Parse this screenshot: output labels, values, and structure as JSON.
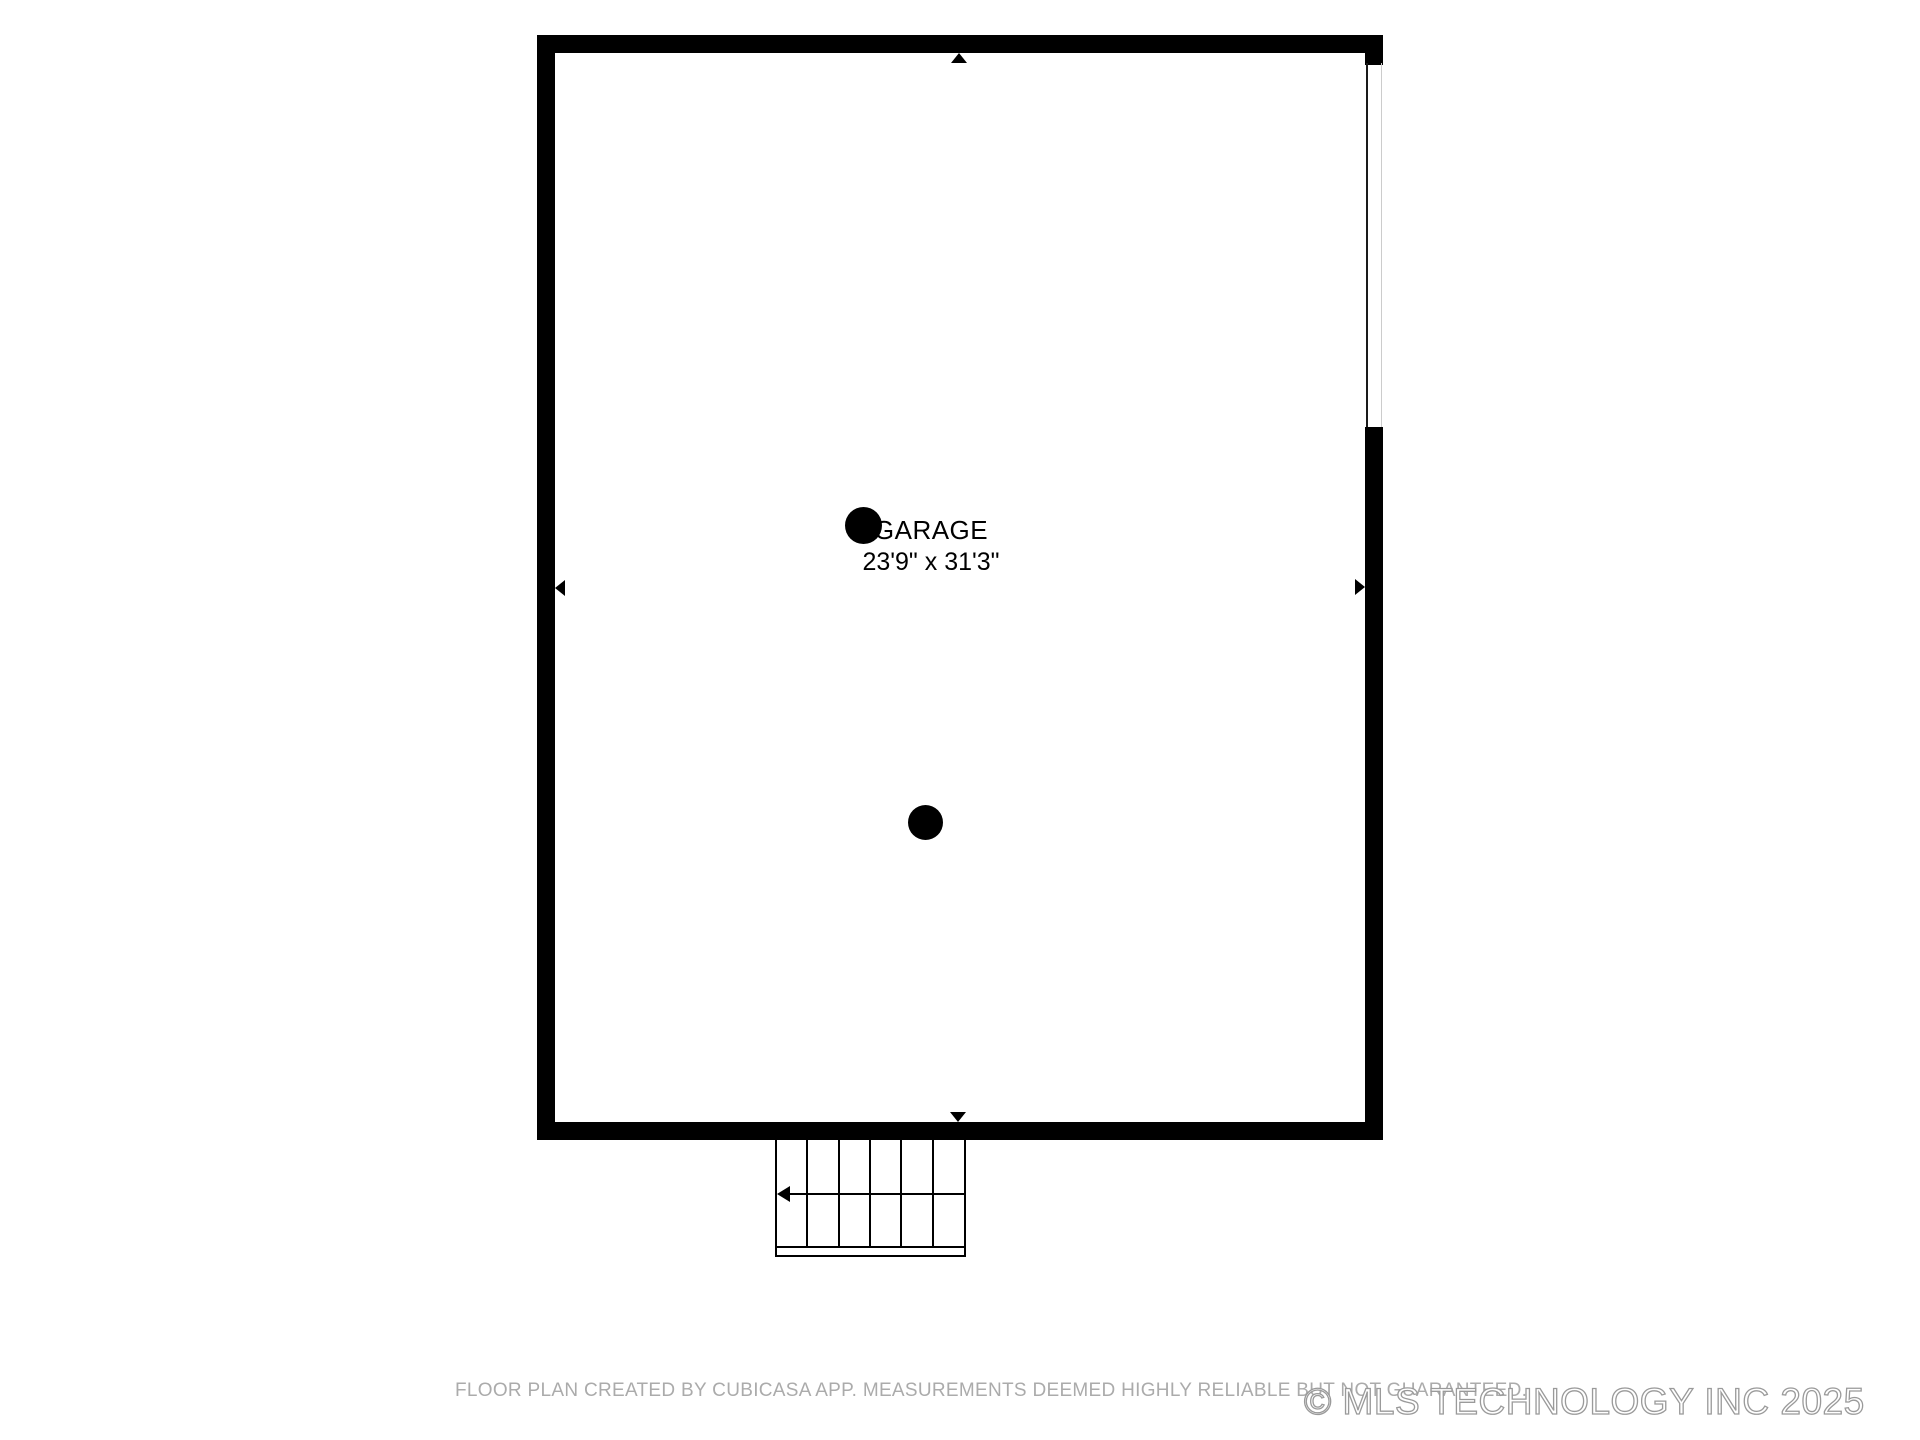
{
  "room": {
    "label": "GARAGE",
    "dimensions": "23'9\" x 31'3\""
  },
  "footer": {
    "disclaimer": "FLOOR PLAN CREATED BY CUBICASA APP. MEASUREMENTS DEEMED HIGHLY RELIABLE BUT NOT GUARANTEED.",
    "watermark": "© MLS TECHNOLOGY INC 2025"
  },
  "colors": {
    "wall": "#000000",
    "room_text": "#000000",
    "disclaimer_text": "#ababab",
    "watermark_outline": "#9a9a9a"
  },
  "icons": {
    "camera_points": "filled-black-circle",
    "dimension_arrows": [
      "up",
      "down",
      "left",
      "right"
    ],
    "stair_direction_arrow": "left"
  }
}
